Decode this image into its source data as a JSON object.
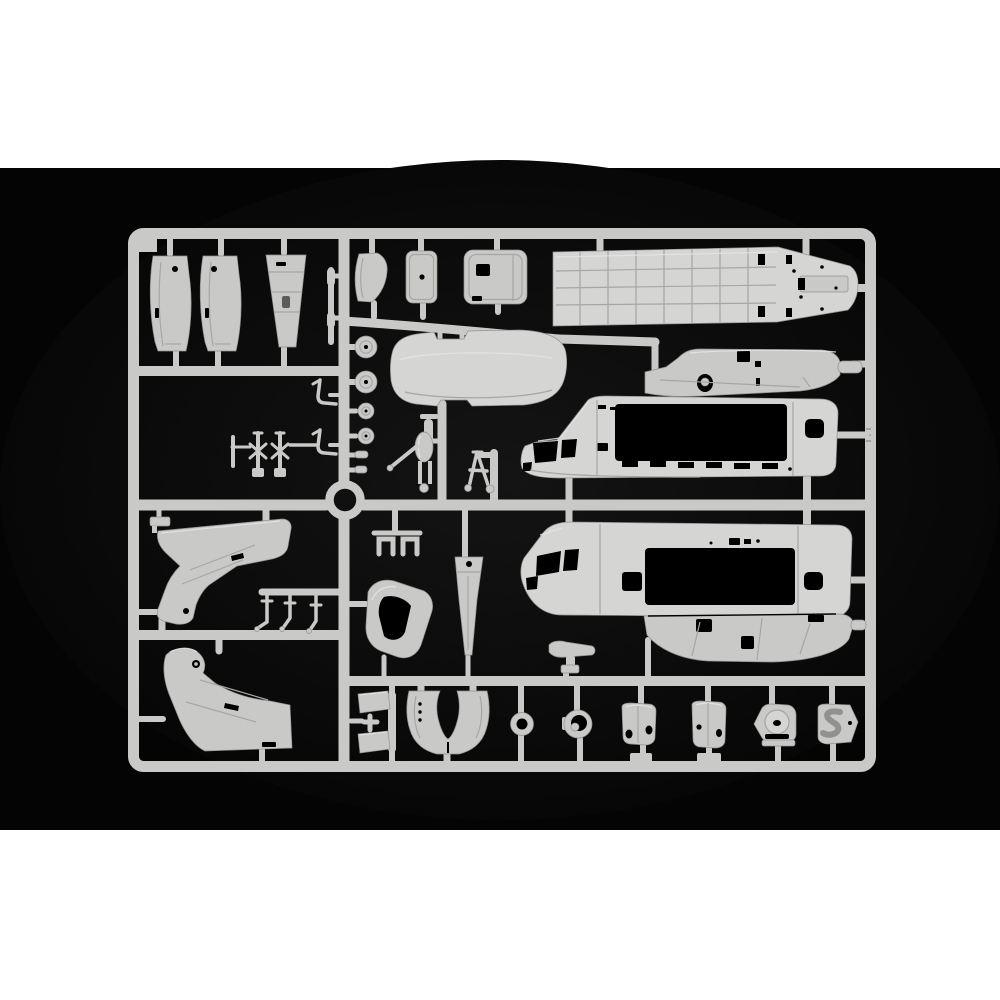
{
  "meta": {
    "type": "product photograph",
    "subject": "Injection-molded light grey polystyrene model kit sprue with helicopter parts, photographed on a black background with white bands above and below",
    "visible_text": "none",
    "orientation": "landscape sprue centered in black field"
  },
  "palette": {
    "page_bg": "#ffffff",
    "photo_bg": "#040404",
    "vignette": "#141414",
    "plastic": "#c9c9c7",
    "plastic_bright": "#d5d5d3",
    "plastic_light": "#e4e4e2",
    "plastic_dark": "#91918f",
    "panel_line": "#a6a6a4",
    "cutout": "#000000"
  },
  "composition": {
    "white_band_top": [
      0,
      0,
      1000,
      168
    ],
    "photo_area": [
      0,
      168,
      1000,
      662
    ],
    "white_band_bottom": [
      0,
      830,
      1000,
      170
    ],
    "sprue_outer_frame": [
      128,
      228,
      748,
      544
    ],
    "divider_x": 344,
    "cross_rail_y": [
      321,
      371,
      505,
      592,
      635,
      681
    ],
    "molding_ring_center": [
      345,
      500
    ]
  },
  "parts": [
    {
      "id": "side-panel-a",
      "label": "narrow curved fuselage side panel",
      "bbox": [
        149,
        253,
        44,
        99
      ]
    },
    {
      "id": "side-panel-b",
      "label": "narrow curved fuselage side panel",
      "bbox": [
        199,
        253,
        44,
        99
      ]
    },
    {
      "id": "tapered-fin-panel",
      "label": "tapered fin / pylon skin panel",
      "bbox": [
        265,
        253,
        41,
        95
      ]
    },
    {
      "id": "thin-strip",
      "label": "thin strip part",
      "bbox": [
        326,
        266,
        14,
        80
      ]
    },
    {
      "id": "curved-cowl-panel",
      "label": "curved cowl panel",
      "bbox": [
        354,
        252,
        34,
        51
      ]
    },
    {
      "id": "access-panel",
      "label": "small access panel with hole",
      "bbox": [
        406,
        250,
        31,
        53
      ]
    },
    {
      "id": "sliding-door-panel",
      "label": "sliding door panel with window cutout",
      "bbox": [
        464,
        249,
        63,
        55
      ]
    },
    {
      "id": "cabin-floor-panel",
      "label": "long cabin floor panel with rib grid and rear ramp",
      "bbox": [
        552,
        245,
        306,
        82
      ]
    },
    {
      "id": "wheel-large-a",
      "label": "main wheel",
      "bbox": [
        355,
        336,
        22,
        22
      ]
    },
    {
      "id": "wheel-large-b",
      "label": "main wheel",
      "bbox": [
        355,
        371,
        22,
        22
      ]
    },
    {
      "id": "wheel-small-a",
      "label": "nose wheel",
      "bbox": [
        358,
        403,
        16,
        16
      ]
    },
    {
      "id": "wheel-small-b",
      "label": "nose wheel",
      "bbox": [
        358,
        428,
        16,
        16
      ]
    },
    {
      "id": "hub-bit-a",
      "label": "small cylinder fitting",
      "bbox": [
        355,
        451,
        13,
        7
      ]
    },
    {
      "id": "hub-bit-b",
      "label": "small cylinder fitting",
      "bbox": [
        355,
        466,
        12,
        7
      ]
    },
    {
      "id": "bent-rod-a",
      "label": "bent rod / grab handle",
      "bbox": [
        312,
        377,
        26,
        28
      ]
    },
    {
      "id": "bent-rod-b",
      "label": "bent rod / grab handle",
      "bbox": [
        312,
        427,
        26,
        28
      ]
    },
    {
      "id": "rotor-head-cluster",
      "label": "rotor head linkage cluster",
      "bbox": [
        228,
        430,
        62,
        50
      ]
    },
    {
      "id": "cabin-roof-panel",
      "label": "cabin roof panel",
      "bbox": [
        390,
        330,
        178,
        77
      ]
    },
    {
      "id": "landing-gear-strut-a",
      "label": "landing gear strut with fork",
      "bbox": [
        388,
        412,
        52,
        81
      ]
    },
    {
      "id": "landing-gear-strut-b",
      "label": "landing gear A-frame strut",
      "bbox": [
        466,
        447,
        28,
        45
      ]
    },
    {
      "id": "engine-deck-fairing",
      "label": "engine deck fairing with rotor mast opening",
      "bbox": [
        641,
        341,
        226,
        55
      ]
    },
    {
      "id": "fuselage-half-upper",
      "label": "fuselage half with cockpit and cargo door opening",
      "bbox": [
        520,
        396,
        319,
        82
      ]
    },
    {
      "id": "fuselage-half-lower",
      "label": "opposite fuselage half with cockpit and cargo door opening",
      "bbox": [
        521,
        522,
        332,
        95
      ]
    },
    {
      "id": "belly-pan",
      "label": "lower belly pan with sponson details",
      "bbox": [
        643,
        608,
        212,
        54
      ]
    },
    {
      "id": "tail-pylon-upper",
      "label": "tail pylon half",
      "bbox": [
        156,
        518,
        136,
        107
      ]
    },
    {
      "id": "tail-pylon-lower",
      "label": "tail pylon half (mirror)",
      "bbox": [
        162,
        646,
        130,
        105
      ]
    },
    {
      "id": "pipe-fittings",
      "label": "three small bent pipe fittings on sub-rail",
      "bbox": [
        256,
        588,
        68,
        44
      ]
    },
    {
      "id": "bracket-clips",
      "label": "pair of U-bracket clips",
      "bbox": [
        374,
        530,
        48,
        26
      ]
    },
    {
      "id": "canopy-frame",
      "label": "curved canopy frame with window opening",
      "bbox": [
        365,
        578,
        68,
        82
      ]
    },
    {
      "id": "rotor-blade",
      "label": "tapered rotor blade root",
      "bbox": [
        455,
        552,
        28,
        103
      ]
    },
    {
      "id": "stabilizer-t",
      "label": "horizontal stabilizer with mount",
      "bbox": [
        548,
        640,
        48,
        34
      ]
    },
    {
      "id": "small-latch",
      "label": "small latch fitting",
      "bbox": [
        148,
        503,
        24,
        24
      ]
    },
    {
      "id": "clamp-blocks",
      "label": "clamp blocks with cross fitting",
      "bbox": [
        356,
        691,
        42,
        62
      ]
    },
    {
      "id": "intake-cowl-u",
      "label": "U-shaped intake cowl",
      "bbox": [
        406,
        689,
        84,
        66
      ]
    },
    {
      "id": "ring-small",
      "label": "small ring / tire",
      "bbox": [
        510,
        712,
        24,
        24
      ]
    },
    {
      "id": "hub-ring",
      "label": "wheel hub ring",
      "bbox": [
        562,
        709,
        32,
        30
      ]
    },
    {
      "id": "fairing-panel-a",
      "label": "small fairing panel with oval holes",
      "bbox": [
        621,
        703,
        36,
        42
      ]
    },
    {
      "id": "fairing-panel-b",
      "label": "small fairing panel with holes",
      "bbox": [
        691,
        701,
        36,
        47
      ]
    },
    {
      "id": "port-plate",
      "label": "plate with circular port boss",
      "bbox": [
        753,
        704,
        44,
        42
      ]
    },
    {
      "id": "s-duct-plate",
      "label": "plate with S-shaped duct recess",
      "bbox": [
        817,
        704,
        42,
        40
      ]
    },
    {
      "id": "molding-ring",
      "label": "circular runner ring at rail junction",
      "bbox": [
        327,
        482,
        36,
        36
      ]
    }
  ]
}
